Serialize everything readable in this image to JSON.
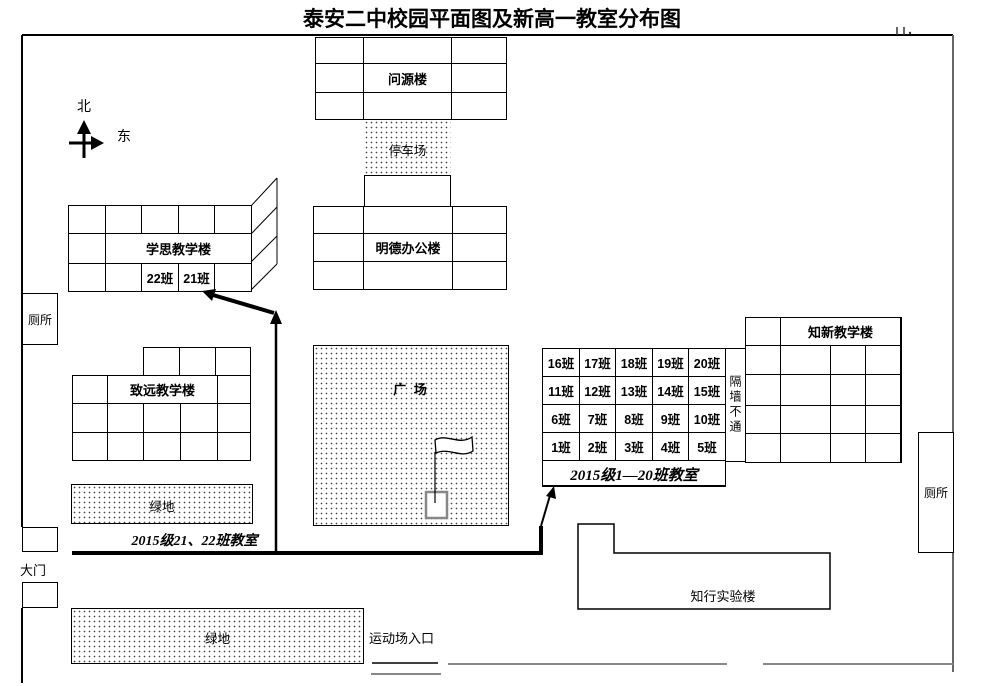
{
  "title": "泰安二中校园平面图及新高一教室分布图",
  "compass": {
    "north_label": "北",
    "east_label": "东"
  },
  "buildings": {
    "wenyuan_label": "问源楼",
    "parking_label": "停车场",
    "mingde_label": "明德办公楼",
    "xuesi_label": "学思教学楼",
    "xuesi_class_22": "22班",
    "xuesi_class_21": "21班",
    "zhiyuan_label": "致远教学楼",
    "plaza_label": "广 场",
    "zhixin_label": "知新教学楼",
    "partition_label": "隔墙不通",
    "zhixing_label": "知行实验楼"
  },
  "facilities": {
    "toilet_left_label": "厕所",
    "toilet_right_label": "厕所",
    "green_top_label": "绿地",
    "green_bottom_label": "绿地",
    "gate_label": "大门",
    "sports_entrance_label": "运动场入口"
  },
  "classroom_grid": {
    "cells": [
      "16班",
      "17班",
      "18班",
      "19班",
      "20班",
      "11班",
      "12班",
      "13班",
      "14班",
      "15班",
      "6班",
      "7班",
      "8班",
      "9班",
      "10班",
      "1班",
      "2班",
      "3班",
      "4班",
      "5班"
    ],
    "caption": "2015级1—20班教室"
  },
  "captions": {
    "label_21_22": "2015级21、22班教室"
  },
  "colors": {
    "line": "#000000",
    "wall_gray": "#888888",
    "background": "#ffffff"
  }
}
